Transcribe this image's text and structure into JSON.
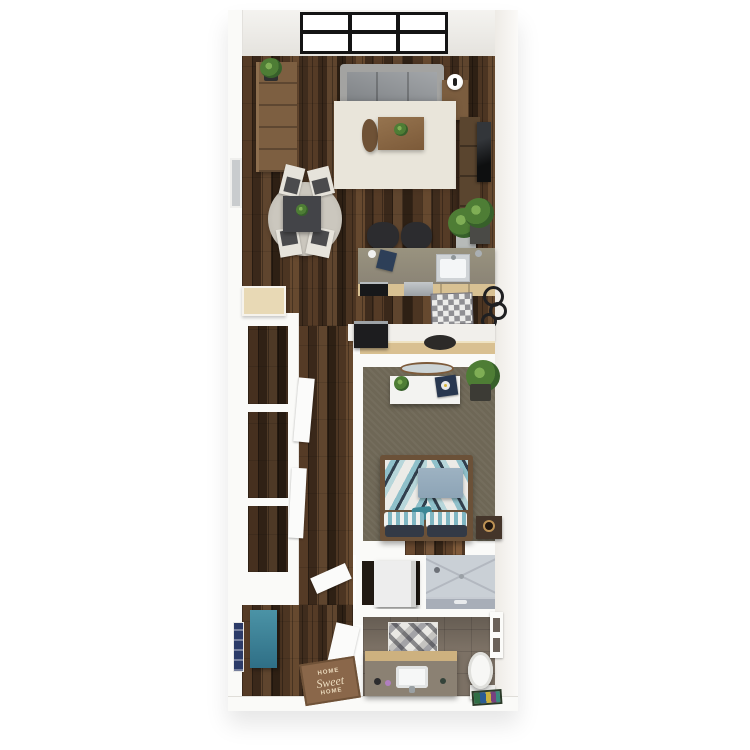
{
  "scene": {
    "type": "3d-rendered-floor-plan",
    "layout": "narrow one-bedroom apartment, top-down dollhouse view",
    "rooms": [
      "living-room",
      "dining-area",
      "kitchen",
      "hallway-with-closets",
      "bedroom",
      "laundry-closet",
      "shower",
      "bathroom",
      "entry"
    ]
  },
  "doormat": {
    "line1": "HOME",
    "line2": "Sweet",
    "line3": "HOME"
  },
  "palette": {
    "wood_floor": "#46301f",
    "wall_white": "#fafaf8",
    "rug_cream": "#e9e5da",
    "sofa_gray": "#a3a3a1",
    "counter_taupe": "#90897b",
    "cabinet_wood": "#d8c193",
    "carpet_olive": "#6e6756",
    "bathroom_tile": "#7c7165",
    "bed_teal": "#8fc0ca",
    "bed_navy": "#32404e",
    "bench_blue": "#3e7f96",
    "artwork_navy": "#2c3b68",
    "doormat_brown": "#8a674a"
  },
  "furniture": {
    "living_room": [
      "window-wall",
      "bookshelf",
      "potted-plant",
      "sofa",
      "side-table",
      "sphere-lamp",
      "cream-rug",
      "coffee-table",
      "curved-stool",
      "tv-console",
      "wall-tv",
      "fern-plant"
    ],
    "dining_area": [
      "round-rug",
      "dining-table",
      "dining-chair",
      "dining-chair",
      "dining-chair",
      "dining-chair",
      "west-window"
    ],
    "kitchen": [
      "island-counter",
      "sink",
      "bar-stool",
      "bar-stool",
      "notebook",
      "stove",
      "dishwasher",
      "cabinet-row",
      "checkered-mat",
      "potted-plant",
      "gear-wall-art",
      "refrigerator",
      "coffee-bar-counter",
      "counter-stool"
    ],
    "hallway": [
      "closet-niche",
      "closet-niche",
      "closet-niche",
      "closet-door",
      "closet-door",
      "closet-shelf-door"
    ],
    "bedroom": [
      "dresser",
      "oval-mirror",
      "record-player",
      "dresser-plant",
      "floor-plant",
      "bed",
      "gray-blanket",
      "pillows",
      "nightstand",
      "clock"
    ],
    "laundry": [
      "washer"
    ],
    "bathroom": [
      "shower",
      "shower-glass",
      "mosaic-tile-panel",
      "vanity",
      "sink-basin",
      "toilet",
      "rainbow-mat",
      "recessed-shelf",
      "door-panel"
    ],
    "entry": [
      "blue-bench",
      "navy-wall-art",
      "doormat",
      "door-panel"
    ]
  }
}
